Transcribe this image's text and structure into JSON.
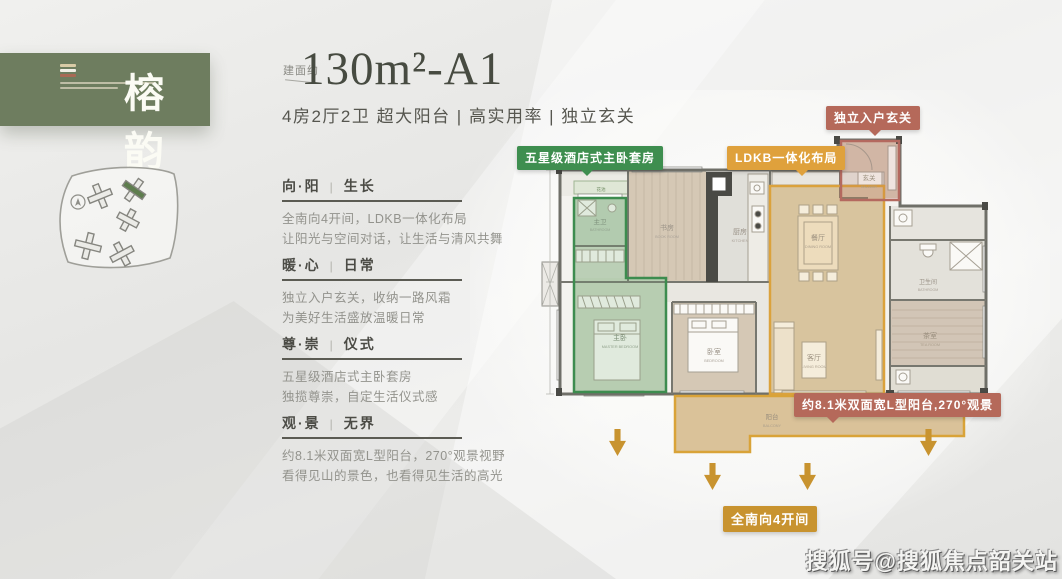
{
  "brand": {
    "name": "榕韵"
  },
  "title": {
    "prefix": "建面约",
    "main": "130m²-A1",
    "subtitle": "4房2厅2卫  超大阳台 | 高实用率 | 独立玄关"
  },
  "ui": {
    "separator": "|"
  },
  "sections": [
    {
      "key": "向·阳",
      "value": "生长",
      "lines": [
        "全南向4开间，LDKB一体化布局",
        "让阳光与空间对话，让生活与清风共舞"
      ]
    },
    {
      "key": "暖·心",
      "value": "日常",
      "lines": [
        "独立入户玄关，收纳一路风霜",
        "为美好生活盛放温暖日常"
      ]
    },
    {
      "key": "尊·崇",
      "value": "仪式",
      "lines": [
        "五星级酒店式主卧套房",
        "独揽尊崇，自定生活仪式感"
      ]
    },
    {
      "key": "观·景",
      "value": "无界",
      "lines": [
        "约8.1米双面宽L型阳台，270°观景视野",
        "看得见山的景色，也看得见生活的高光"
      ]
    }
  ],
  "plan": {
    "badges": {
      "master_suite": "五星级酒店式主卧套房",
      "ldkb": "LDKB一体化布局",
      "entry": "独立入户玄关",
      "balcony": "约8.1米双面宽L型阳台,270°观景",
      "south": "全南向4开间"
    },
    "rooms": {
      "flower_bed": {
        "cn": "花池",
        "en": "FLOWER BED"
      },
      "master_bath": {
        "cn": "主卫",
        "en": "BATHROOM"
      },
      "master_bed": {
        "cn": "主卧",
        "en": "MASTER BEDROOM"
      },
      "study": {
        "cn": "书房",
        "en": "BOOK ROOM"
      },
      "kitchen": {
        "cn": "厨房",
        "en": "KITCHEN"
      },
      "bedroom": {
        "cn": "卧室",
        "en": "BEDROOM"
      },
      "dining": {
        "cn": "餐厅",
        "en": "DINING ROOM"
      },
      "living": {
        "cn": "客厅",
        "en": "LIVING ROOM"
      },
      "hallway": {
        "cn": "玄关",
        "en": "HALLWAY"
      },
      "bath": {
        "cn": "卫生间",
        "en": "BATHROOM"
      },
      "tea": {
        "cn": "茶室",
        "en": "TEA ROOM"
      },
      "balcony": {
        "cn": "阳台",
        "en": "BALCONY"
      }
    }
  },
  "colors": {
    "header_green": "#6e7d5f",
    "badge_green": "#3e8e4f",
    "badge_orange": "#dfa13c",
    "badge_clay": "#b5695a",
    "badge_gold": "#c8932f"
  },
  "watermark": "搜狐号@搜狐焦点韶关站"
}
